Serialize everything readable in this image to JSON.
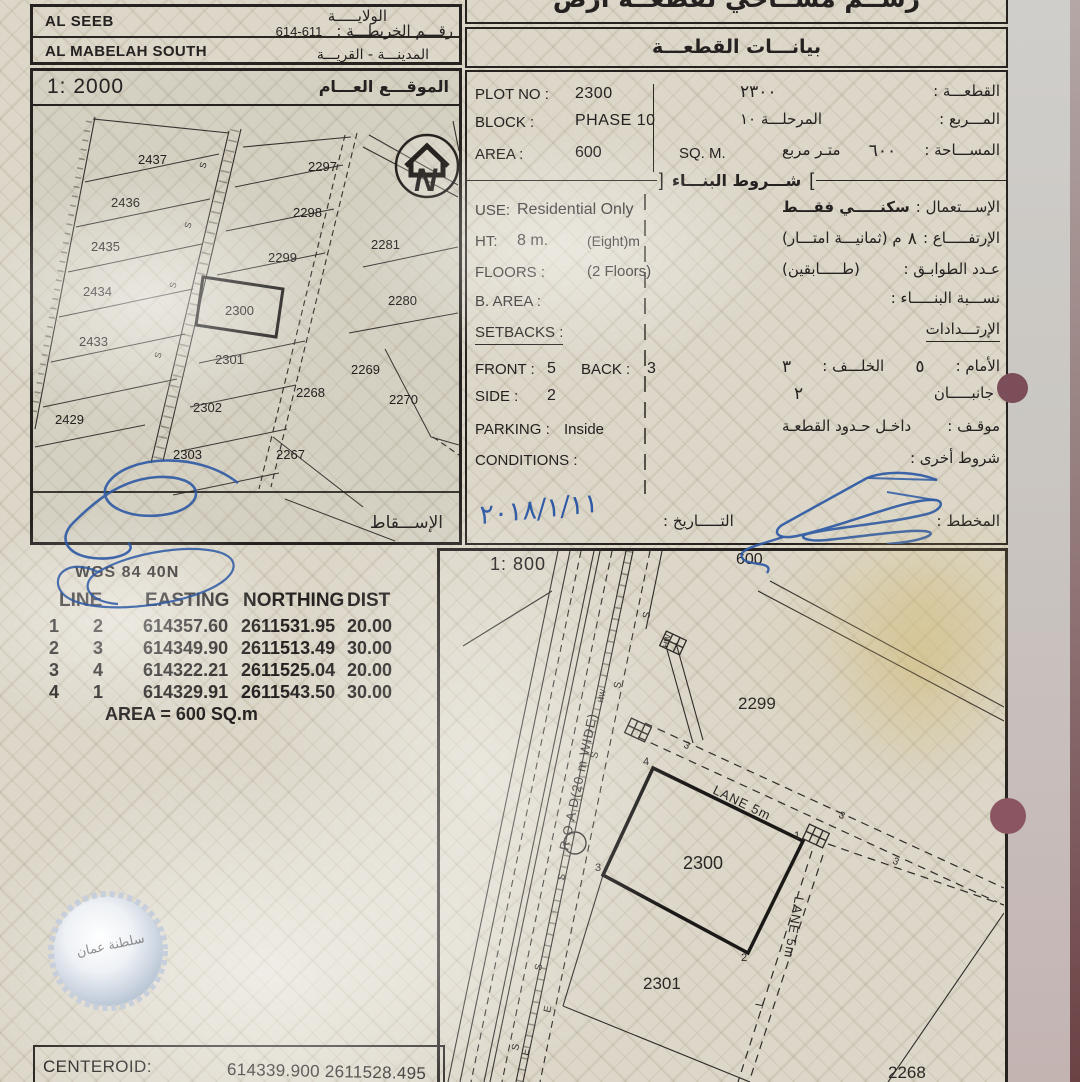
{
  "admin": {
    "wilaya_en": "AL SEEB",
    "city_en": "AL MABELAH SOUTH",
    "wilaya_ar": "الولايـــــة",
    "map_no_label_ar": "رقـــم الخريطـــة :",
    "map_no": "614-611",
    "city_village_ar": "المدينـــة - القريـــة"
  },
  "titles": {
    "doc_title_ar": "رســم مســاحي لقطعــة أرض",
    "plot_data_ar": "بيانـــات القطعـــة",
    "general_location_ar": "الموقـــع العـــام",
    "projection_ar": "الإســـقاط",
    "building_conditions_ar": "شـــروط البنـــاء",
    "bracket_right": "]",
    "bracket_left": "["
  },
  "scales": {
    "map_scale": "1: 2000",
    "plan_scale": "1: 800",
    "plan_area_note": "600"
  },
  "north_icon": {
    "letter": "N"
  },
  "plot": {
    "plot_no_label": "PLOT NO :",
    "plot_no": "2300",
    "plot_label_ar": "القطعـــة :",
    "plot_no_ar": "٢٣٠٠",
    "block_label": "BLOCK :",
    "block": "PHASE 10",
    "block_label_ar": "المـــربع :",
    "block_ar": "المرحلـــة ١٠",
    "area_label": "AREA :",
    "area": "600",
    "area_unit": "SQ. M.",
    "area_label_ar": "المســـاحة :",
    "area_ar": "٦٠٠",
    "area_unit_ar": "متـر مربع"
  },
  "conditions": {
    "use_label": "USE:",
    "use": "Residential Only",
    "use_label_ar": "الإســـتعمال :",
    "use_ar": "سكنـــــي فقـــط",
    "ht_label": "HT:",
    "ht": "8 m.",
    "ht_note": "(Eight)m",
    "ht_label_ar": "الإرتفـــــاع :",
    "ht_ar": "٨",
    "ht_note_ar": "م  (ثمانيـــة امتـــار)",
    "floors_label": "FLOORS :",
    "floors": "(2 Floors)",
    "floors_label_ar": "عـدد الطوابـق :",
    "floors_ar": "(طـــــابقين)",
    "barea_label": "B. AREA :",
    "barea_label_ar": "نســـبة البنـــــاء :",
    "setbacks_label": "SETBACKS :",
    "setbacks_ar": "الإرتـــدادات",
    "front_label": "FRONT :",
    "front": "5",
    "back_label": "BACK :",
    "back": "3",
    "front_label_ar": "الأمام :",
    "front_ar": "٥",
    "back_label_ar": "الخلـــف :",
    "back_ar": "٣",
    "side_label": "SIDE :",
    "side": "2",
    "side_label_ar": "جانبـــــان",
    "side_ar": "٢",
    "parking_label": "PARKING :",
    "parking": "Inside",
    "parking_label_ar": "موقـف :",
    "parking_ar": "داخـل حـدود القطعـة",
    "conditions_label": "CONDITIONS :",
    "conditions_label_ar": "شروط أخرى :"
  },
  "signoff": {
    "date_label_ar": "التـــــاريخ :",
    "date_handwritten": "٢٠١٨/١/١١",
    "planner_label_ar": "المخطط :"
  },
  "coords": {
    "datum": "WGS 84  40N",
    "headers": [
      "LINE",
      "EASTING",
      "NORTHING",
      "DIST"
    ],
    "rows": [
      {
        "from": "1",
        "to": "2",
        "easting": "614357.60",
        "northing": "2611531.95",
        "dist": "20.00"
      },
      {
        "from": "2",
        "to": "3",
        "easting": "614349.90",
        "northing": "2611513.49",
        "dist": "30.00"
      },
      {
        "from": "3",
        "to": "4",
        "easting": "614322.21",
        "northing": "2611525.04",
        "dist": "20.00"
      },
      {
        "from": "4",
        "to": "1",
        "easting": "614329.91",
        "northing": "2611543.50",
        "dist": "30.00"
      }
    ],
    "area_text": "AREA = 600  SQ.m"
  },
  "centeroid": {
    "label": "CENTEROID:",
    "value": "614339.900 2611528.495"
  },
  "map2000": {
    "plots": [
      "2437",
      "2297",
      "2436",
      "2298",
      "2435",
      "2281",
      "2299",
      "2434",
      "2300",
      "2280",
      "2433",
      "2301",
      "2269",
      "2268",
      "2270",
      "2429",
      "2302",
      "2303",
      "2267"
    ],
    "mark_s": "S"
  },
  "map800": {
    "road_label": "R O A D(20 m WIDE)",
    "lane_top_label": "LANE 5m",
    "lane_right_label": "LANE 5m",
    "plot_2299": "2299",
    "plot_2300": "2300",
    "plot_2301": "2301",
    "plot_2268": "2268",
    "corners": [
      "1",
      "2",
      "3",
      "4"
    ],
    "mark_s": "S",
    "mark_e": "E",
    "mark_t": "T",
    "mark_hw": "HW",
    "mark_3": "3"
  },
  "seal": {
    "text_ar": "سلطنة عمان"
  },
  "colors": {
    "ink": "#26221f",
    "pen_blue": "#2d59a4",
    "paper": "#dcd7c9",
    "punch": "#7c4e59"
  }
}
